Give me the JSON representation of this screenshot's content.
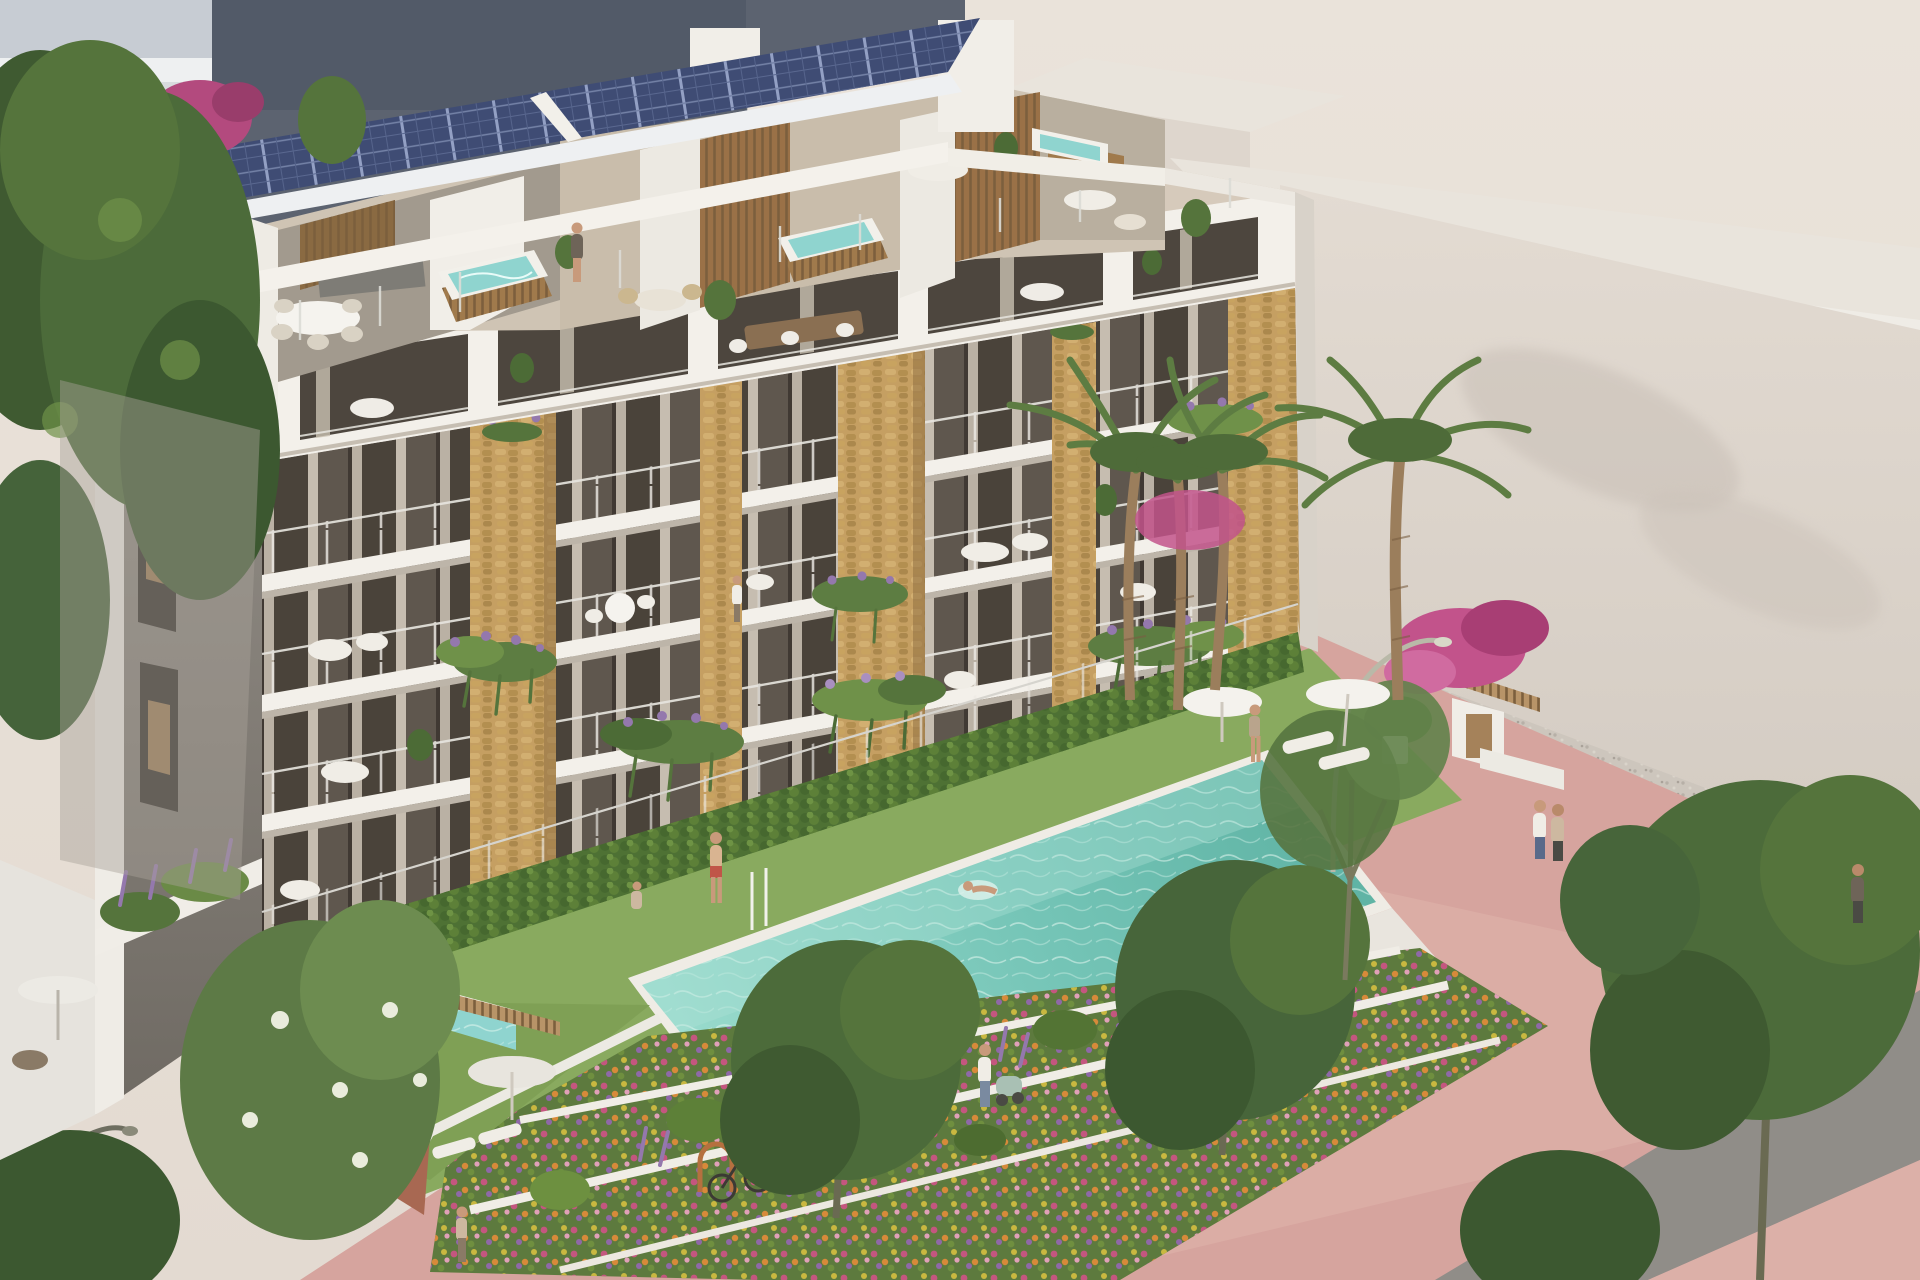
{
  "image_type": "architectural-3d-render",
  "scene": {
    "description": "Aerial 3D rendering of a modern six-level apartment building with rooftop solar panels, penthouse terraces with hot tubs, stone-clad balcony piers with cascading plants, a long turquoise lap pool on a lawn, terraced flower beds, a pink paved promenade with bike racks and trees, palm trees and hazy neighbouring buildings.",
    "building": {
      "balcony_floors_visible": 4,
      "penthouse_terraces": true,
      "rooftop_solar_panels": true,
      "hot_tubs_on_roof": 3,
      "stone_piers": 5
    },
    "amenities": [
      "lap pool",
      "private plunge pool",
      "sun loungers",
      "parasols",
      "bike racks",
      "street lamp",
      "terraced flower gardens",
      "lawn"
    ],
    "vegetation": [
      "palm trees",
      "bougainvillea",
      "lavender",
      "hanging ferns",
      "hedges",
      "promenade trees"
    ],
    "people": [
      "swimmer in pool",
      "woman standing by pool",
      "boy walking on lawn",
      "woman on penthouse terrace",
      "woman in private garden",
      "man with stroller",
      "couple walking on promenade",
      "pedestrian near road",
      "woman seated on balcony"
    ]
  },
  "palette": {
    "sky": "#e9e1d8",
    "neighbor_gray": "#c7ccd3",
    "dark_building": "#5c6370",
    "dark_building_band": "#9c8695",
    "dark_building_base": "#b4adb0",
    "ghost_top": "#e9e4dc",
    "ghost_face": "#c6c9cf",
    "bg_wall": "#ded6cd",
    "gravel": "#cdc6bd",
    "band_white": "#f3f0ea",
    "side_wall": "#8a857e",
    "facade_recess": "#675d53",
    "stone": "#c59f62",
    "hedge": "#4e7134",
    "lawn": "#85a75b",
    "pool_water": "#74c4b6",
    "coping": "#efece5",
    "bed_base": "#5d7a3e",
    "promenade": "#d6a49e",
    "road": "#908d88",
    "tree_dark": "#3f5a31",
    "tree_mid": "#55743c",
    "palm_green": "#5d7c42",
    "wood": "#a07a4c",
    "tub_water": "#8fd4cf",
    "solar": "#3f4c74",
    "flower_pink": "#c45a86",
    "lavender": "#9478ad"
  }
}
